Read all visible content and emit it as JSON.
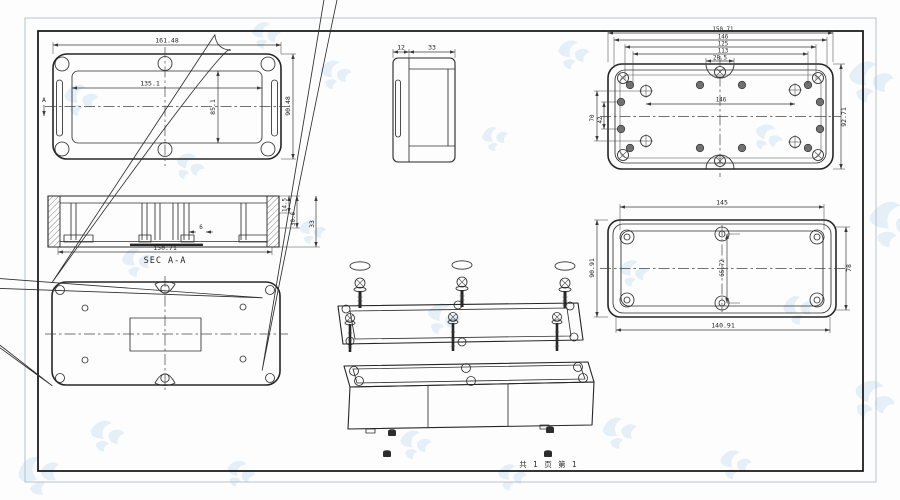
{
  "sheet": {
    "footer": "共 1 页  第 1"
  },
  "views": {
    "lid_top": {
      "width": "161.48",
      "inner_width": "135.1",
      "inner_height": "85.1",
      "height": "90.48",
      "section_marker": "A"
    },
    "side_view": {
      "lid_thickness": "12",
      "body_depth": "33"
    },
    "base_interior": {
      "stack": [
        "150.71",
        "146",
        "125",
        "113",
        "28.5"
      ],
      "hole_span": "146",
      "height": "92.71",
      "left_spans": [
        "70",
        "42"
      ]
    },
    "section_aa": {
      "label": "SEC A-A",
      "width": "150.71",
      "depth_small": "14.5",
      "depth_large": "30.6",
      "height": "33",
      "rib_width": "6"
    },
    "cover_underside": {
      "top_width": "145",
      "bottom_width": "140.91",
      "left_height": "90.91",
      "right_height": "78",
      "screw_span": "65.72"
    }
  },
  "colors": {
    "line": "#262626",
    "watermark": "#cfe3f2",
    "frame_outer": "#b9c2cc",
    "frame_inner": "#1d1d1d"
  }
}
